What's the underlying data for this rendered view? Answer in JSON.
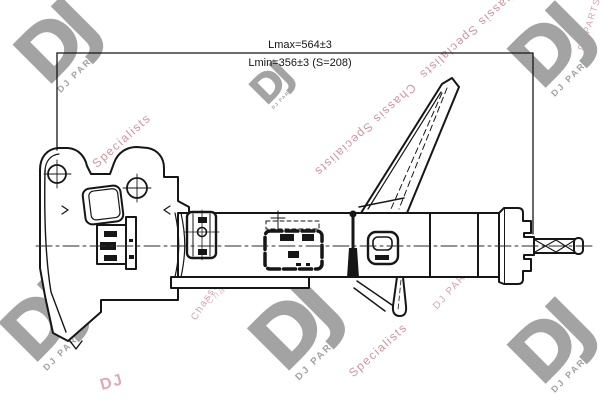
{
  "drawing": {
    "background": "#ffffff",
    "line_color": "#161616",
    "part_type_note": "suspension strut technical drawing",
    "dimensions": {
      "lmax_label": "Lmax=564±3",
      "lmin_label": "Lmin=356±3 (S=208)"
    }
  },
  "brand": {
    "logo_letters": "DJ",
    "logo_caption": "DJ PARTS",
    "logo_color": "#a3a3a3"
  },
  "watermarks": {
    "text_full": "Chassis Specialists",
    "text_word1": "Chassis",
    "text_word2": "Specialists",
    "brand_text": "DJ PARTS",
    "stamp_text": "DJ",
    "color": "#c2707f"
  }
}
